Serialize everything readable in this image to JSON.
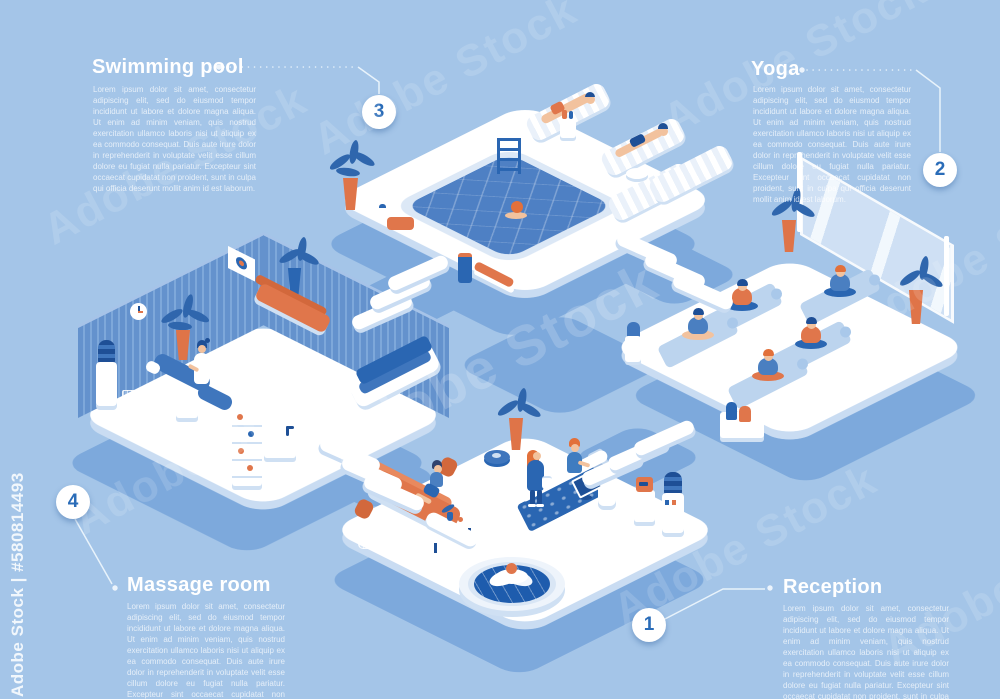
{
  "image": {
    "width": 1000,
    "height": 699,
    "background": "#a4c5e8",
    "style": "isometric 3d wellness spa infographic"
  },
  "watermark": {
    "tile_text": "Adobe Stock",
    "side_text": "Adobe Stock | #580814493"
  },
  "palette": {
    "background": "#a4c5e8",
    "platform": "#ffffff",
    "platform_side": "#c9dcf2",
    "ground_shadow": "#7da9dc",
    "wall_blue": "#6492cd",
    "accent_orange": "#e0764b",
    "navy": "#1e4f96",
    "mid_blue": "#3f76bd",
    "water": "#4e80c4",
    "skin": "#f2c29e",
    "number_blue": "#2a6cb8",
    "mat_blue": "#bcd4ee"
  },
  "sections": [
    {
      "id": "swimming-pool",
      "number": "3",
      "title": "Swimming pool",
      "body": "Lorem ipsum dolor sit amet, consectetur adipiscing elit, sed do eiusmod tempor incididunt ut labore et dolore magna aliqua. Ut enim ad minim veniam, quis nostrud exercitation ullamco laboris nisi ut aliquip ex ea commodo consequat. Duis aute irure dolor in reprehenderit in voluptate velit esse cillum dolore eu fugiat nulla pariatur. Excepteur sint occaecat cupidatat non proident, sunt in culpa qui officia deserunt mollit anim id est laborum."
    },
    {
      "id": "yoga",
      "number": "2",
      "title": "Yoga",
      "body": "Lorem ipsum dolor sit amet, consectetur adipiscing elit, sed do eiusmod tempor incididunt ut labore et dolore magna aliqua. Ut enim ad minim veniam, quis nostrud exercitation ullamco laboris nisi ut aliquip ex ea commodo consequat. Duis aute irure dolor in reprehenderit in voluptate velit esse cillum dolore eu fugiat nulla pariatur. Excepteur sint occaecat cupidatat non proident, sunt in culpa qui officia deserunt mollit anim id est laborum."
    },
    {
      "id": "massage-room",
      "number": "4",
      "title": "Massage room",
      "body": "Lorem ipsum dolor sit amet, consectetur adipiscing elit, sed do eiusmod tempor incididunt ut labore et dolore magna aliqua. Ut enim ad minim veniam, quis nostrud exercitation ullamco laboris nisi ut aliquip ex ea commodo consequat. Duis aute irure dolor in reprehenderit in voluptate velit esse cillum dolore eu fugiat nulla pariatur. Excepteur sint occaecat cupidatat non proident, sunt in culpa qui officia deserunt mollit anim id est laborum."
    },
    {
      "id": "reception",
      "number": "1",
      "title": "Reception",
      "body": "Lorem ipsum dolor sit amet, consectetur adipiscing elit, sed do eiusmod tempor incididunt ut labore et dolore magna aliqua. Ut enim ad minim veniam, quis nostrud exercitation ullamco laboris nisi ut aliquip ex ea commodo consequat. Duis aute irure dolor in reprehenderit in voluptate velit esse cillum dolore eu fugiat nulla pariatur. Excepteur sint occaecat cupidatat non proident, sunt in culpa qui officia deserunt mollit anim id est laborum."
    }
  ],
  "scene": {
    "rooms": [
      {
        "name": "swimming-pool-room",
        "props": [
          "pool",
          "pool-ladder",
          "swimmer",
          "sun-loungers",
          "sunbathing-man",
          "sunbathing-woman",
          "drinks-table",
          "palm-plant",
          "towel-stack",
          "water-bottle",
          "trash-bin",
          "bench"
        ]
      },
      {
        "name": "yoga-room",
        "props": [
          "panoramic-window",
          "yoga-mats",
          "meditating-people",
          "potted-plants",
          "towel-box",
          "water-cooler"
        ]
      },
      {
        "name": "massage-room",
        "props": [
          "curtain-walls",
          "wall-clock",
          "picture-frame",
          "massage-table",
          "masseuse",
          "orange-daybed",
          "supply-shelf",
          "sink",
          "water-cooler",
          "trash-basket",
          "palm-plants",
          "waiting-sofa"
        ]
      },
      {
        "name": "reception-room",
        "props": [
          "orange-sofa",
          "waiting-woman",
          "coffee-table",
          "lotus-fountain",
          "reception-desk",
          "receptionist",
          "computer-monitor",
          "customer",
          "weight-scale",
          "coffee-machine",
          "water-cooler",
          "potted-plant",
          "trash-basket"
        ]
      }
    ],
    "connectors": [
      "stairs-massage-to-pool",
      "stairs-pool-to-yoga",
      "stairs-reception-to-yoga",
      "stairs-reception-to-massage"
    ]
  }
}
